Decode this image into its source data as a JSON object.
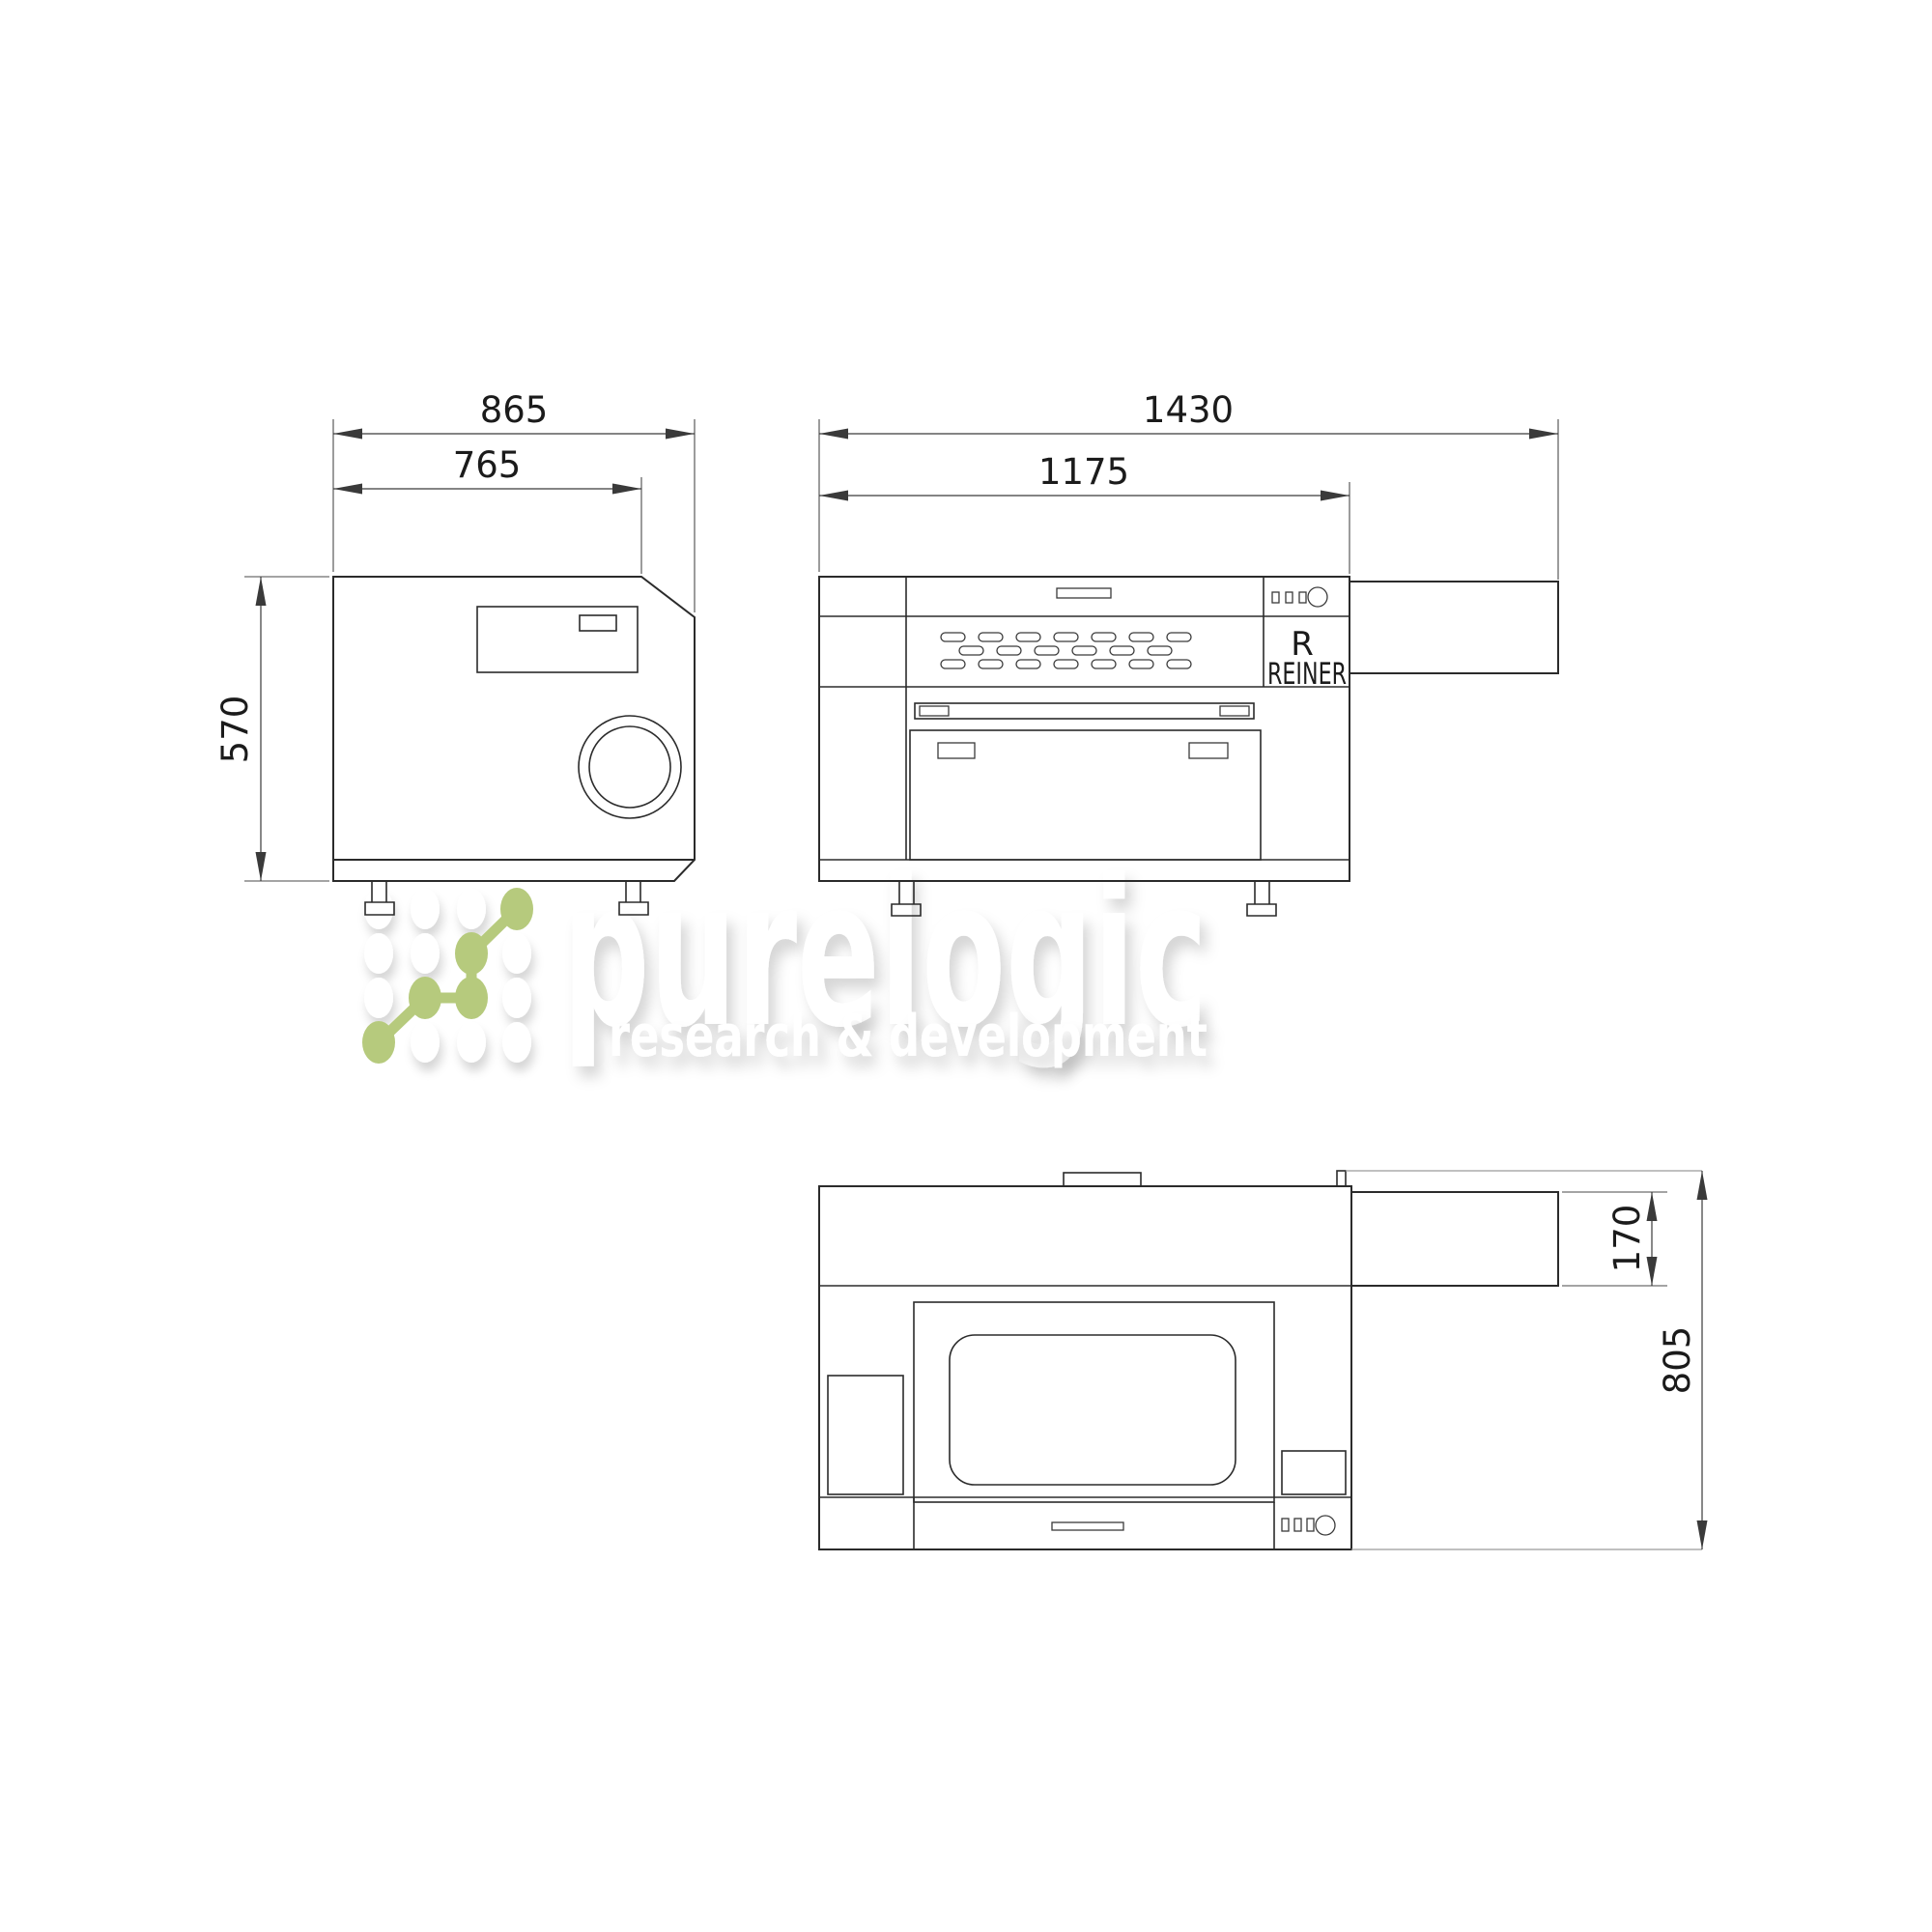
{
  "app": {
    "background": "#ffffff",
    "line_color": "#2b2b2b",
    "thin_line_color": "#9a9a9a",
    "text_color": "#1b1b1b",
    "accent_green": "#b6ca7d",
    "watermark_color": "#ffffff"
  },
  "side_view": {
    "dim_width": "865",
    "dim_inner_width": "765",
    "dim_height": "570"
  },
  "front_view": {
    "dim_width": "1430",
    "dim_inner_width": "1175",
    "logo_initial": "R",
    "logo_text": "REINER"
  },
  "top_view": {
    "dim_extension_depth": "170",
    "dim_depth": "805"
  },
  "watermark": {
    "title": "purelogic",
    "subtitle": "research & development"
  }
}
